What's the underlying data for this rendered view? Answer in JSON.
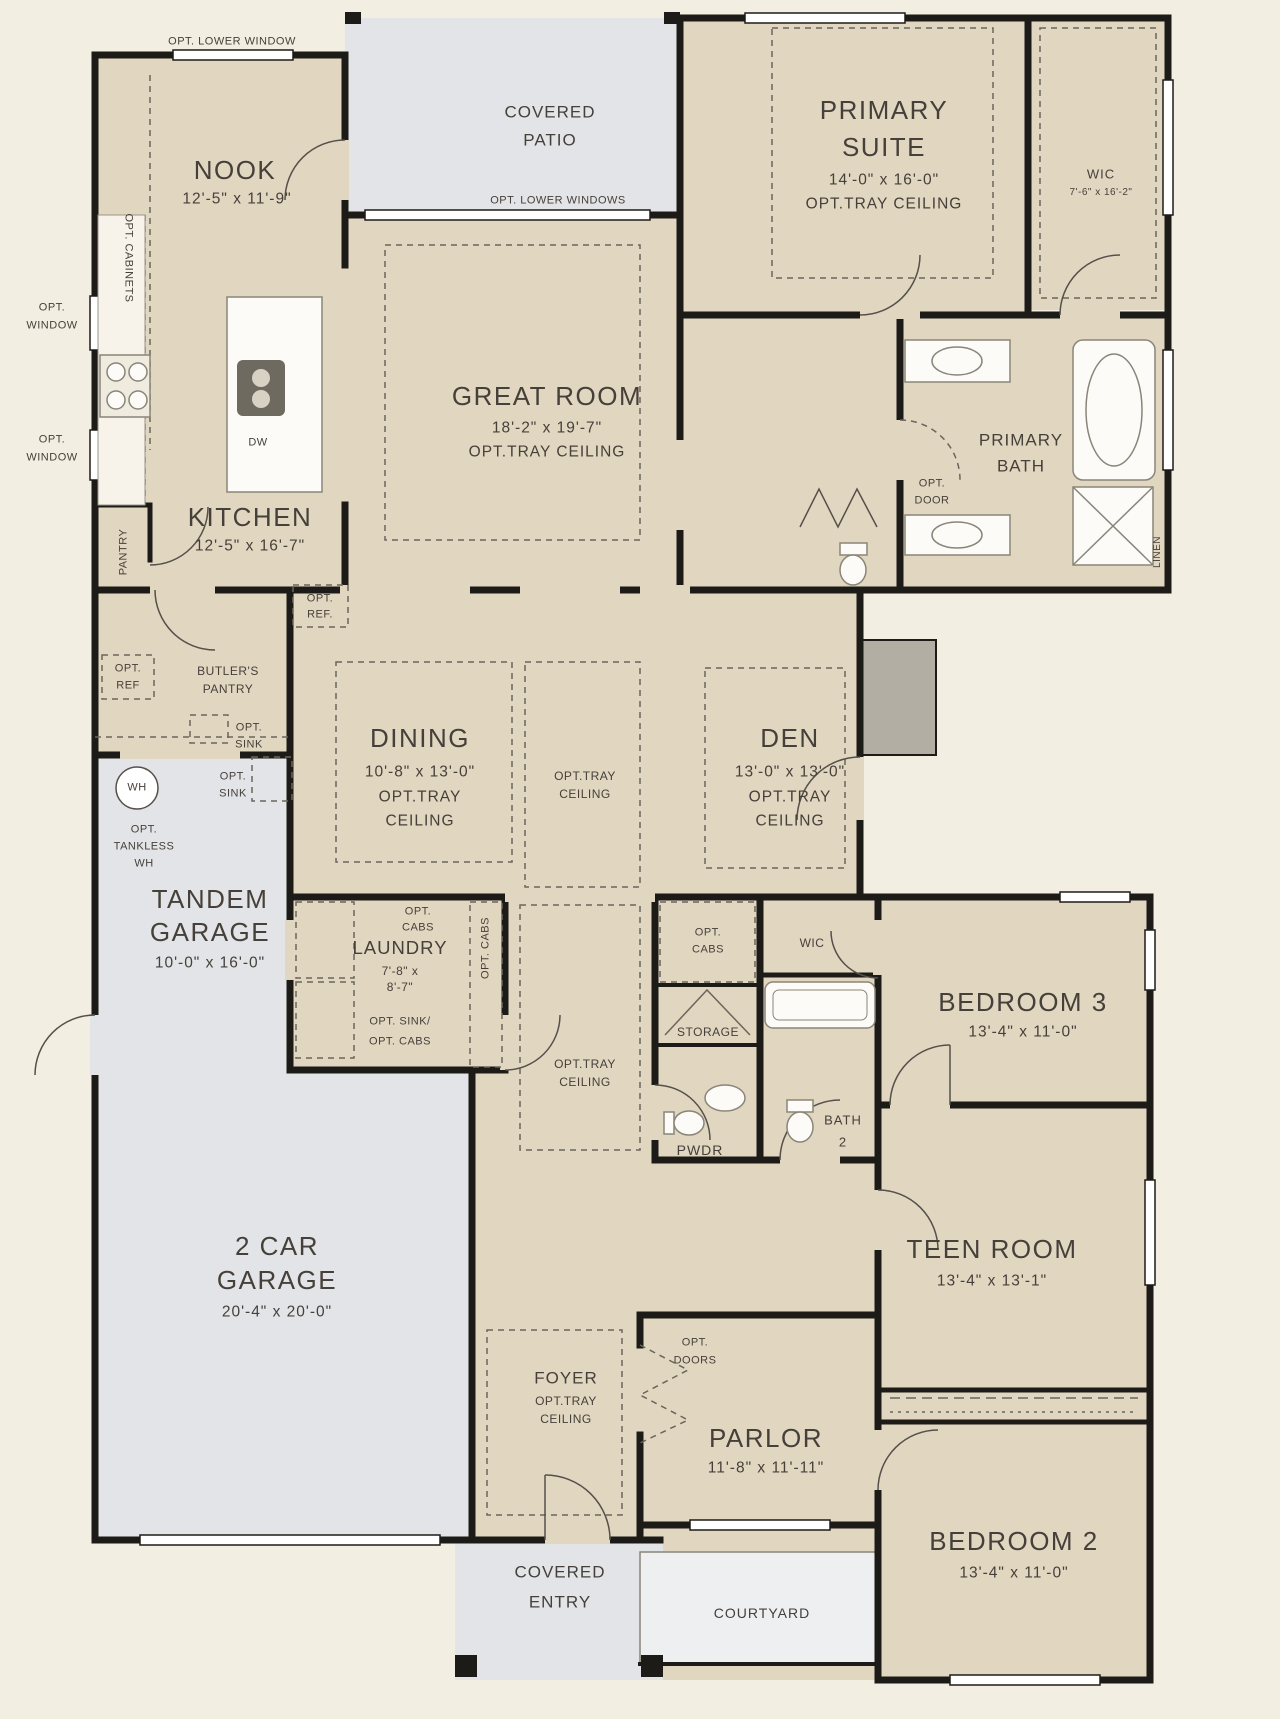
{
  "palette": {
    "background": "#f3eee2",
    "room_fill": "#e1d6c0",
    "outdoor_fill": "#e3e4e7",
    "courtyard_fill": "#edeff1",
    "wall": "#1d1b17",
    "text": "#46403a"
  },
  "rooms": {
    "nook": {
      "name": "NOOK",
      "dims": "12'-5\" x 11'-9\""
    },
    "kitchen": {
      "name": "KITCHEN",
      "dims": "12'-5\" x 16'-7\""
    },
    "covered_patio": {
      "name_line1": "COVERED",
      "name_line2": "PATIO"
    },
    "great_room": {
      "name": "GREAT ROOM",
      "dims": "18'-2\" x 19'-7\"",
      "option": "OPT.TRAY CEILING"
    },
    "primary_suite": {
      "name_line1": "PRIMARY",
      "name_line2": "SUITE",
      "dims": "14'-0\" x 16'-0\"",
      "option": "OPT.TRAY CEILING"
    },
    "primary_wic": {
      "name": "WIC",
      "dims": "7'-6\" x 16'-2\""
    },
    "primary_bath": {
      "name_line1": "PRIMARY",
      "name_line2": "BATH"
    },
    "pantry": {
      "name": "PANTRY"
    },
    "butlers_pantry": {
      "name_line1": "BUTLER'S",
      "name_line2": "PANTRY"
    },
    "dining": {
      "name": "DINING",
      "dims": "10'-8\" x 13'-0\"",
      "option_line1": "OPT.TRAY",
      "option_line2": "CEILING"
    },
    "den": {
      "name": "DEN",
      "dims": "13'-0\" x 13'-0\"",
      "option_line1": "OPT.TRAY",
      "option_line2": "CEILING"
    },
    "hall_tray_a": {
      "line1": "OPT.TRAY",
      "line2": "CEILING"
    },
    "hall_tray_b": {
      "line1": "OPT.TRAY",
      "line2": "CEILING"
    },
    "tandem_garage": {
      "name_line1": "TANDEM",
      "name_line2": "GARAGE",
      "dims": "10'-0\" x 16'-0\""
    },
    "laundry": {
      "name": "LAUNDRY",
      "dims_line1": "7'-8\" x",
      "dims_line2": "8'-7\""
    },
    "storage": {
      "name": "STORAGE"
    },
    "wic2": {
      "name": "WIC"
    },
    "powder": {
      "name": "PWDR"
    },
    "bath2": {
      "name_line1": "BATH",
      "name_line2": "2"
    },
    "bedroom3": {
      "name": "BEDROOM 3",
      "dims": "13'-4\" x 11'-0\""
    },
    "teen_room": {
      "name": "TEEN ROOM",
      "dims": "13'-4\" x 13'-1\""
    },
    "foyer": {
      "name": "FOYER",
      "option_line1": "OPT.TRAY",
      "option_line2": "CEILING"
    },
    "parlor": {
      "name": "PARLOR",
      "dims": "11'-8\" x 11'-11\""
    },
    "two_car_garage": {
      "name_line1": "2 CAR",
      "name_line2": "GARAGE",
      "dims": "20'-4\" x 20'-0\""
    },
    "covered_entry": {
      "name_line1": "COVERED",
      "name_line2": "ENTRY"
    },
    "courtyard": {
      "name": "COURTYARD"
    },
    "bedroom2": {
      "name": "BEDROOM 2",
      "dims": "13'-4\" x 11'-0\""
    }
  },
  "options": {
    "opt_lower_window": "OPT. LOWER WINDOW",
    "opt_lower_windows": "OPT. LOWER WINDOWS",
    "opt_cabinets": "OPT. CABINETS",
    "opt_window_a_line1": "OPT.",
    "opt_window_a_line2": "WINDOW",
    "opt_window_b_line1": "OPT.",
    "opt_window_b_line2": "WINDOW",
    "opt_ref_kitchen_line1": "OPT.",
    "opt_ref_kitchen_line2": "REF.",
    "opt_ref_butlers_line1": "OPT.",
    "opt_ref_butlers_line2": "REF",
    "opt_sink_butlers_line1": "OPT.",
    "opt_sink_butlers_line2": "SINK",
    "opt_sink_garage_line1": "OPT.",
    "opt_sink_garage_line2": "SINK",
    "opt_tankless_line1": "OPT.",
    "opt_tankless_line2": "TANKLESS",
    "opt_tankless_line3": "WH",
    "opt_door_line1": "OPT.",
    "opt_door_line2": "DOOR",
    "opt_cabs_laundry_line1": "OPT.",
    "opt_cabs_laundry_line2": "CABS",
    "opt_cabs_laundry_vertical": "OPT. CABS",
    "opt_sink_cabs_line1": "OPT. SINK/",
    "opt_sink_cabs_line2": "OPT. CABS",
    "opt_cabs_hall_line1": "OPT.",
    "opt_cabs_hall_line2": "CABS",
    "opt_doors_line1": "OPT.",
    "opt_doors_line2": "DOORS"
  },
  "fixtures": {
    "dishwasher": "DW",
    "water_heater": "WH",
    "linen": "LINEN"
  }
}
